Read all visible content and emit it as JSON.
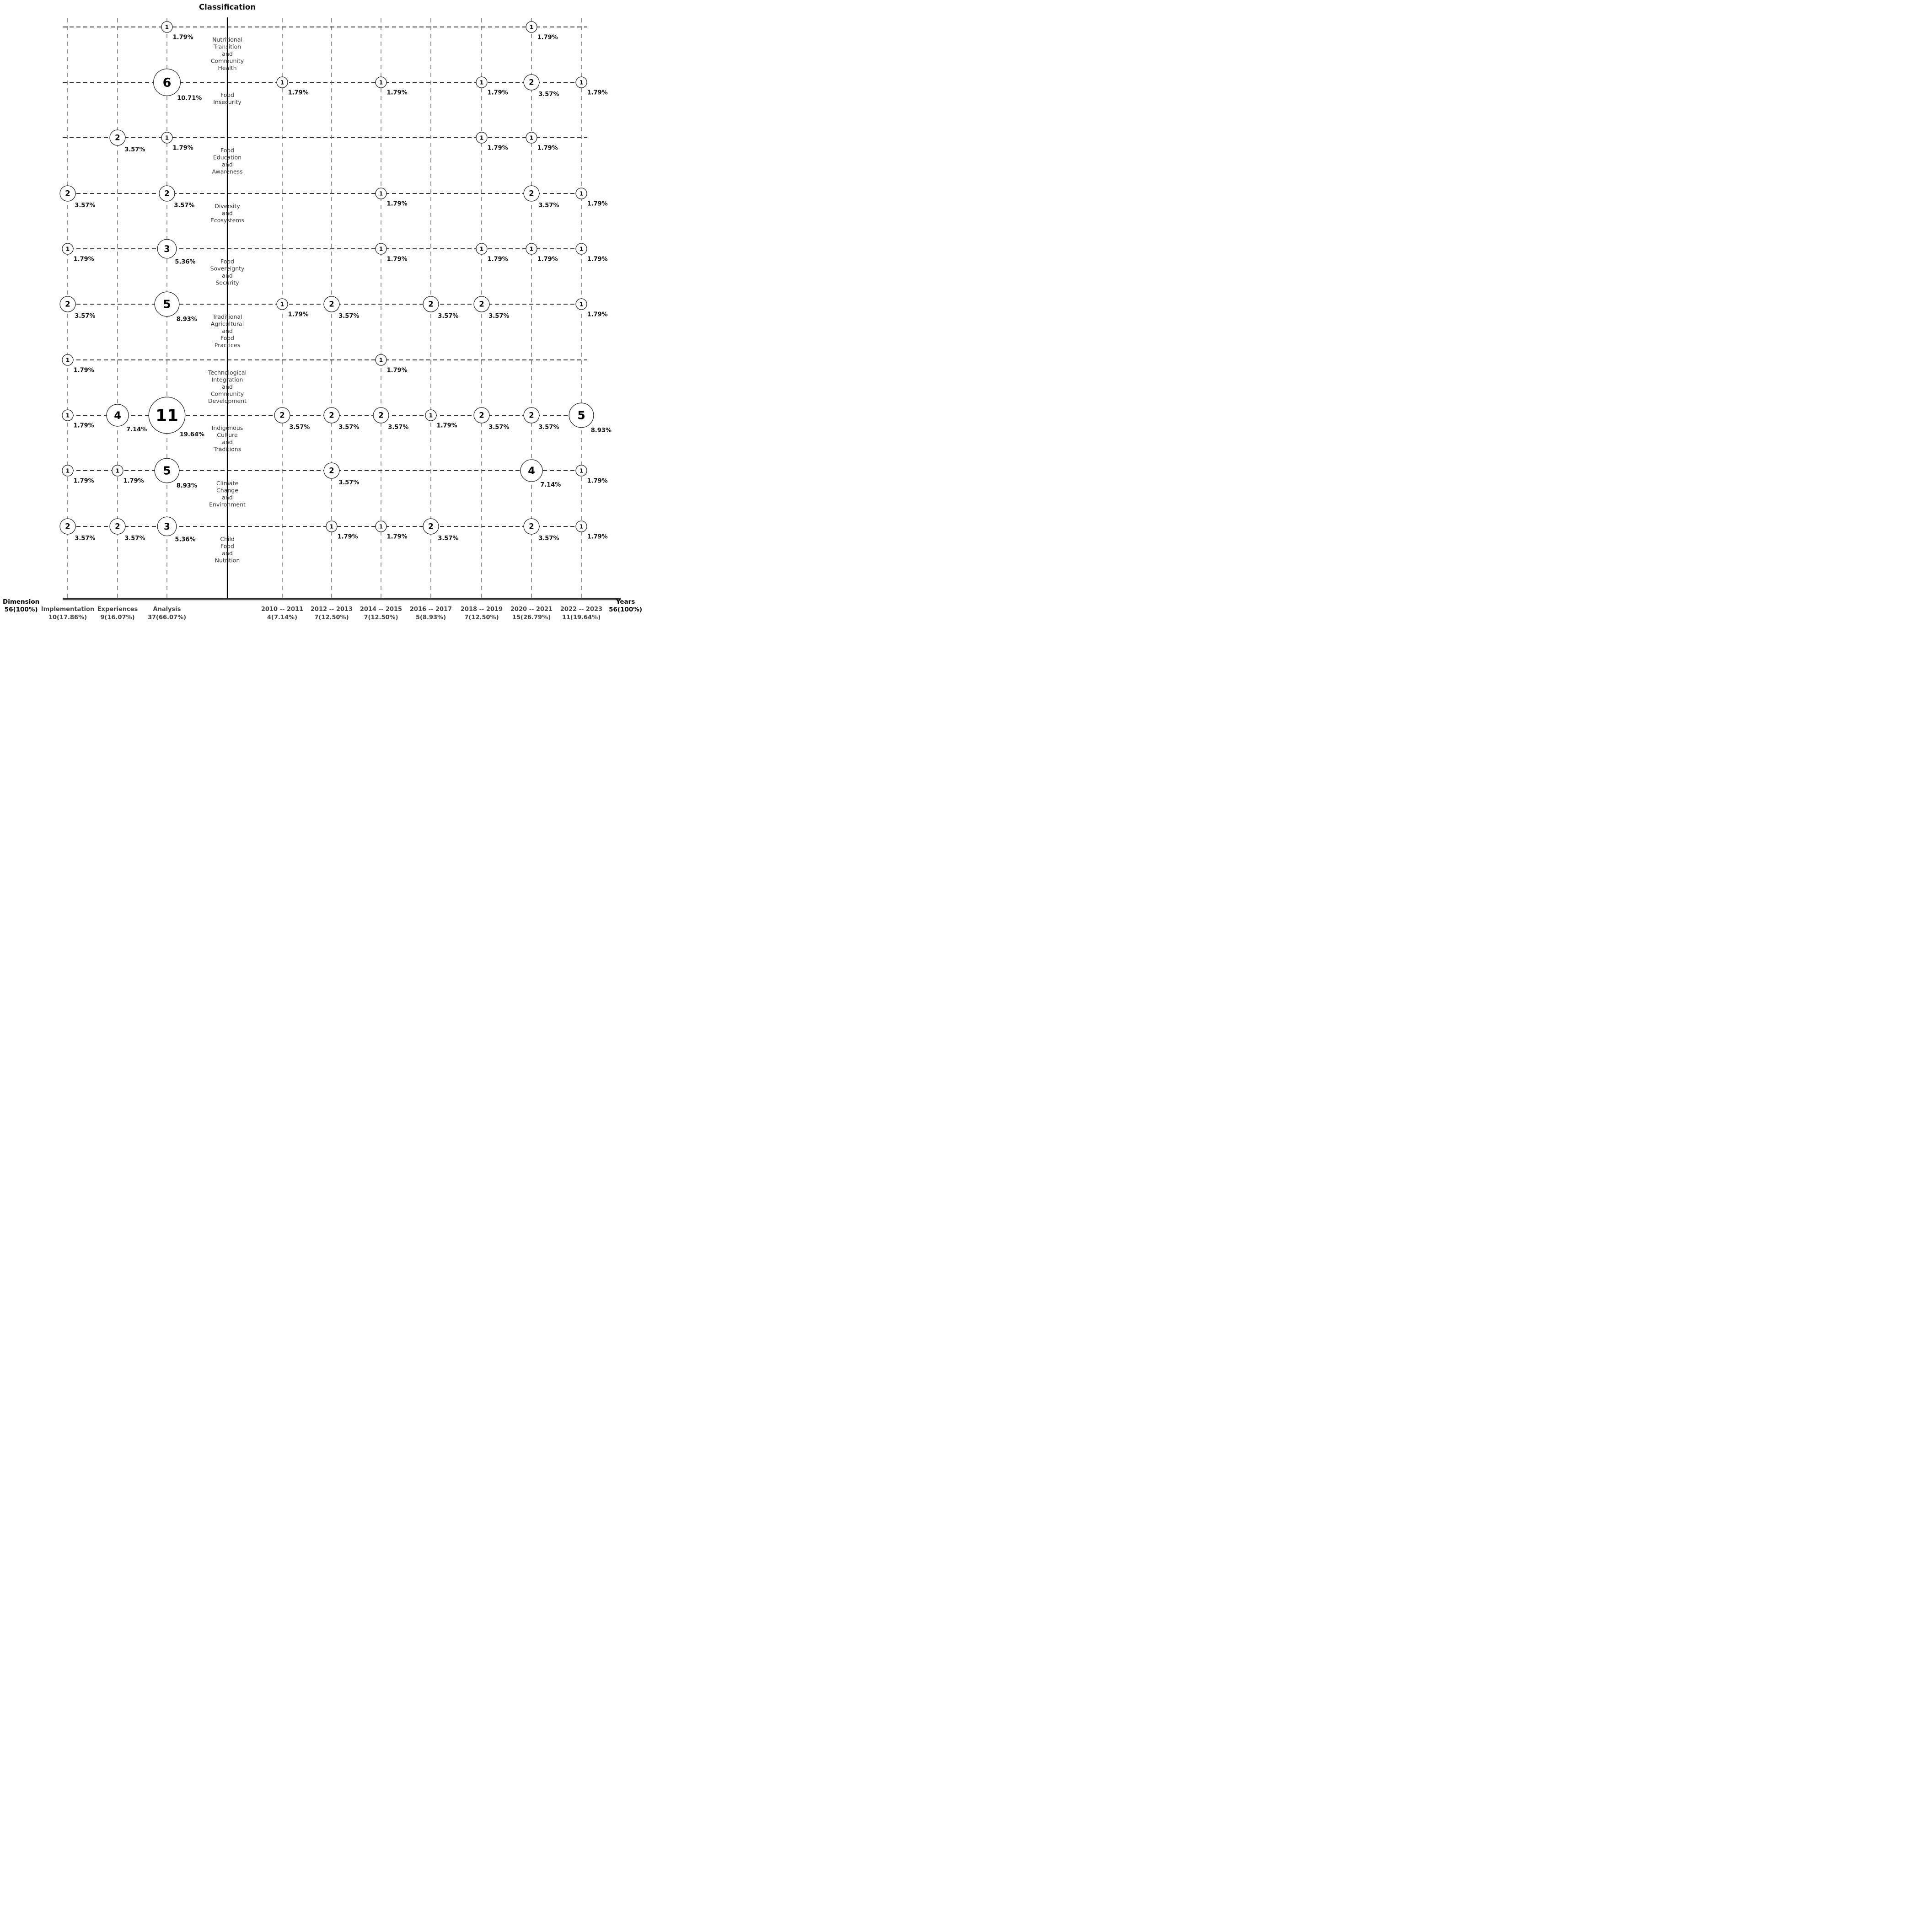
{
  "title": "Classification",
  "left_axis": {
    "label": "Dimension",
    "total": "56(100%)"
  },
  "right_axis": {
    "label": "Years",
    "total": "56(100%)"
  },
  "chart_data": {
    "type": "scatter",
    "subtype": "bubble-matrix",
    "title": "Classification",
    "grand_total": 56,
    "legend_position": "none",
    "grid": "dashed",
    "columns": [
      {
        "id": "implementation",
        "group": "Dimension",
        "label": "Implementation",
        "total": 10,
        "total_label": "10(17.86%)"
      },
      {
        "id": "experiences",
        "group": "Dimension",
        "label": "Experiences",
        "total": 9,
        "total_label": "9(16.07%)"
      },
      {
        "id": "analysis",
        "group": "Dimension",
        "label": "Analysis",
        "total": 37,
        "total_label": "37(66.07%)"
      },
      {
        "id": "y2010_2011",
        "group": "Years",
        "label": "2010 -- 2011",
        "total": 4,
        "total_label": "4(7.14%)"
      },
      {
        "id": "y2012_2013",
        "group": "Years",
        "label": "2012 -- 2013",
        "total": 7,
        "total_label": "7(12.50%)"
      },
      {
        "id": "y2014_2015",
        "group": "Years",
        "label": "2014 -- 2015",
        "total": 7,
        "total_label": "7(12.50%)"
      },
      {
        "id": "y2016_2017",
        "group": "Years",
        "label": "2016 -- 2017",
        "total": 5,
        "total_label": "5(8.93%)"
      },
      {
        "id": "y2018_2019",
        "group": "Years",
        "label": "2018 -- 2019",
        "total": 7,
        "total_label": "7(12.50%)"
      },
      {
        "id": "y2020_2021",
        "group": "Years",
        "label": "2020 -- 2021",
        "total": 15,
        "total_label": "15(26.79%)"
      },
      {
        "id": "y2022_2023",
        "group": "Years",
        "label": "2022 -- 2023",
        "total": 11,
        "total_label": "11(19.64%)"
      }
    ],
    "rows": [
      {
        "label": "Nutritional Transition and Community Health",
        "lines": [
          "Nutritional",
          "Transition",
          "and",
          "Community",
          "Health"
        ],
        "cells": [
          {
            "col": 2,
            "count": 1,
            "pct": "1.79%"
          },
          {
            "col": 8,
            "count": 1,
            "pct": "1.79%"
          }
        ]
      },
      {
        "label": "Food Insecurity",
        "lines": [
          "Food",
          "Insecurity"
        ],
        "cells": [
          {
            "col": 2,
            "count": 6,
            "pct": "10.71%"
          },
          {
            "col": 3,
            "count": 1,
            "pct": "1.79%"
          },
          {
            "col": 5,
            "count": 1,
            "pct": "1.79%"
          },
          {
            "col": 7,
            "count": 1,
            "pct": "1.79%"
          },
          {
            "col": 8,
            "count": 2,
            "pct": "3.57%"
          },
          {
            "col": 9,
            "count": 1,
            "pct": "1.79%"
          }
        ]
      },
      {
        "label": "Food Education and Awareness",
        "lines": [
          "Food",
          "Education",
          "and",
          "Awareness"
        ],
        "cells": [
          {
            "col": 1,
            "count": 2,
            "pct": "3.57%"
          },
          {
            "col": 2,
            "count": 1,
            "pct": "1.79%"
          },
          {
            "col": 7,
            "count": 1,
            "pct": "1.79%"
          },
          {
            "col": 8,
            "count": 1,
            "pct": "1.79%"
          }
        ]
      },
      {
        "label": "Diversity and Ecosystems",
        "lines": [
          "Diversity",
          "and",
          "Ecosystems"
        ],
        "cells": [
          {
            "col": 0,
            "count": 2,
            "pct": "3.57%"
          },
          {
            "col": 2,
            "count": 2,
            "pct": "3.57%"
          },
          {
            "col": 5,
            "count": 1,
            "pct": "1.79%"
          },
          {
            "col": 8,
            "count": 2,
            "pct": "3.57%"
          },
          {
            "col": 9,
            "count": 1,
            "pct": "1.79%"
          }
        ]
      },
      {
        "label": "Food Sovereignty and Security",
        "lines": [
          "Food",
          "Sovereignty",
          "and",
          "Security"
        ],
        "cells": [
          {
            "col": 0,
            "count": 1,
            "pct": "1.79%"
          },
          {
            "col": 2,
            "count": 3,
            "pct": "5.36%"
          },
          {
            "col": 5,
            "count": 1,
            "pct": "1.79%"
          },
          {
            "col": 7,
            "count": 1,
            "pct": "1.79%"
          },
          {
            "col": 8,
            "count": 1,
            "pct": "1.79%"
          },
          {
            "col": 9,
            "count": 1,
            "pct": "1.79%"
          }
        ]
      },
      {
        "label": "Traditional Agricultural and Food Practices",
        "lines": [
          "Traditional",
          "Agricultural",
          "and",
          "Food",
          "Practices"
        ],
        "cells": [
          {
            "col": 0,
            "count": 2,
            "pct": "3.57%"
          },
          {
            "col": 2,
            "count": 5,
            "pct": "8.93%"
          },
          {
            "col": 3,
            "count": 1,
            "pct": "1.79%"
          },
          {
            "col": 4,
            "count": 2,
            "pct": "3.57%"
          },
          {
            "col": 6,
            "count": 2,
            "pct": "3.57%"
          },
          {
            "col": 7,
            "count": 2,
            "pct": "3.57%"
          },
          {
            "col": 9,
            "count": 1,
            "pct": "1.79%"
          }
        ]
      },
      {
        "label": "Technological Integration and Community Development",
        "lines": [
          "Technological",
          "Integration",
          "and",
          "Community",
          "Development"
        ],
        "cells": [
          {
            "col": 0,
            "count": 1,
            "pct": "1.79%"
          },
          {
            "col": 5,
            "count": 1,
            "pct": "1.79%"
          }
        ]
      },
      {
        "label": "Indigenous Culture and Traditions",
        "lines": [
          "Indigenous",
          "Culture",
          "and",
          "Traditions"
        ],
        "cells": [
          {
            "col": 0,
            "count": 1,
            "pct": "1.79%"
          },
          {
            "col": 1,
            "count": 4,
            "pct": "7.14%"
          },
          {
            "col": 2,
            "count": 11,
            "pct": "19.64%"
          },
          {
            "col": 3,
            "count": 2,
            "pct": "3.57%"
          },
          {
            "col": 4,
            "count": 2,
            "pct": "3.57%"
          },
          {
            "col": 5,
            "count": 2,
            "pct": "3.57%"
          },
          {
            "col": 6,
            "count": 1,
            "pct": "1.79%"
          },
          {
            "col": 7,
            "count": 2,
            "pct": "3.57%"
          },
          {
            "col": 8,
            "count": 2,
            "pct": "3.57%"
          },
          {
            "col": 9,
            "count": 5,
            "pct": "8.93%"
          }
        ]
      },
      {
        "label": "Climate Change and Environment",
        "lines": [
          "Climate",
          "Change",
          "and",
          "Environment"
        ],
        "cells": [
          {
            "col": 0,
            "count": 1,
            "pct": "1.79%"
          },
          {
            "col": 1,
            "count": 1,
            "pct": "1.79%"
          },
          {
            "col": 2,
            "count": 5,
            "pct": "8.93%"
          },
          {
            "col": 4,
            "count": 2,
            "pct": "3.57%"
          },
          {
            "col": 8,
            "count": 4,
            "pct": "7.14%"
          },
          {
            "col": 9,
            "count": 1,
            "pct": "1.79%"
          }
        ]
      },
      {
        "label": "Child Food and Nutrition",
        "lines": [
          "Child",
          "Food",
          "and",
          "Nutrition"
        ],
        "cells": [
          {
            "col": 0,
            "count": 2,
            "pct": "3.57%"
          },
          {
            "col": 1,
            "count": 2,
            "pct": "3.57%"
          },
          {
            "col": 2,
            "count": 3,
            "pct": "5.36%"
          },
          {
            "col": 4,
            "count": 1,
            "pct": "1.79%"
          },
          {
            "col": 5,
            "count": 1,
            "pct": "1.79%"
          },
          {
            "col": 6,
            "count": 2,
            "pct": "3.57%"
          },
          {
            "col": 8,
            "count": 2,
            "pct": "3.57%"
          },
          {
            "col": 9,
            "count": 1,
            "pct": "1.79%"
          }
        ]
      }
    ]
  },
  "colors": {
    "line_dark": "#1a1a1a",
    "line_gray": "#707070",
    "bubble_stroke": "#2a2a2a",
    "text_dark": "#111111",
    "text_gray": "#3a3a3a",
    "footer_gray": "#444444",
    "baseline": "#2e2e2e",
    "baseline_shadow": "#c8c8c8",
    "background": "#ffffff"
  }
}
